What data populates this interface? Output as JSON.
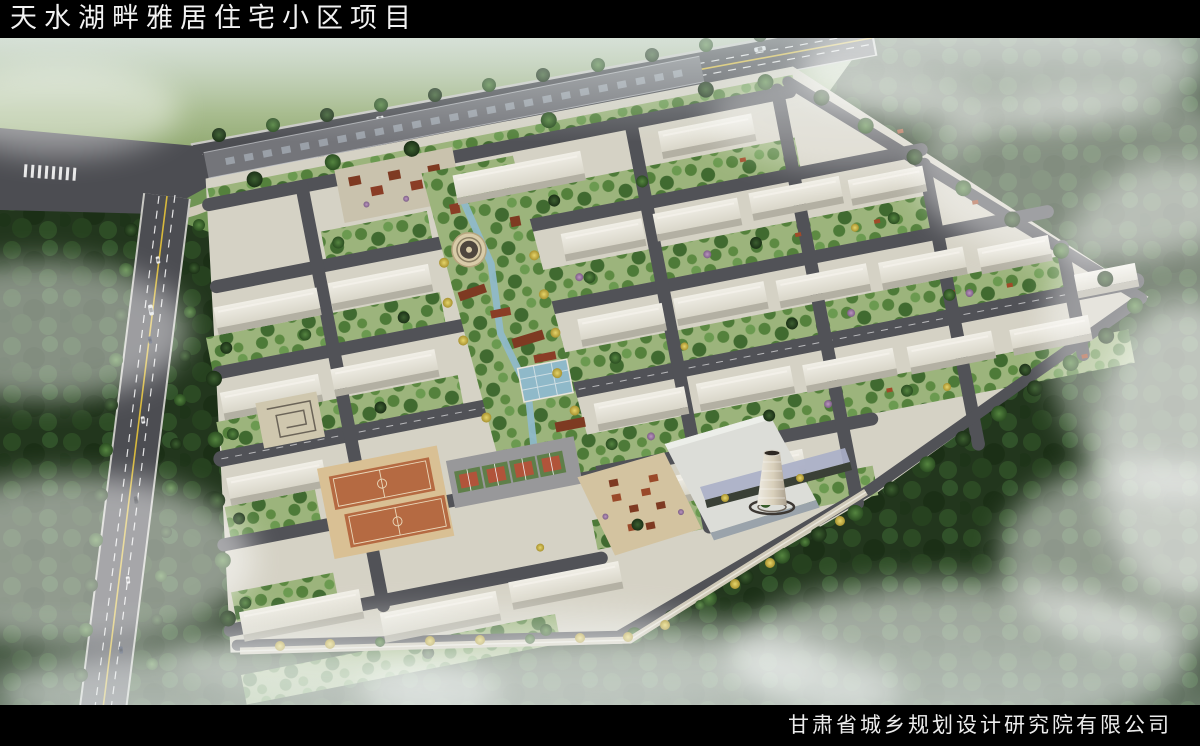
{
  "title_bar": {
    "text": "天水湖畔雅居住宅小区项目"
  },
  "credit_bar": {
    "text": "甘肃省城乡规划设计研究院有限公司"
  },
  "colors": {
    "bar_bg": "#000000",
    "bar_text": "#f2f2f2",
    "forest_green": "#22361d",
    "field_green": "#8aa46e",
    "mist_white": "#ffffff",
    "road_asphalt": "#4c4d52",
    "lane_marking_white": "#ffffff",
    "center_line_yellow": "#d8b93c",
    "site_ground": "#d5d2c5",
    "building_roof_white": "#eceade",
    "building_face_gray": "#b3b0a3",
    "courtyard_green": "#9cb47c",
    "water_blue": "#8fb9c9",
    "basketball_court": "#b56a42",
    "court_apron_tan": "#d9c094",
    "tennis_court_red": "#b1543a",
    "tennis_court_green": "#5f7f4a",
    "pavilion_red": "#7e3a22",
    "bench_red": "#a14a28",
    "yellow_tree": "#d9c553",
    "chimney_tan": "#ddd3c0"
  }
}
